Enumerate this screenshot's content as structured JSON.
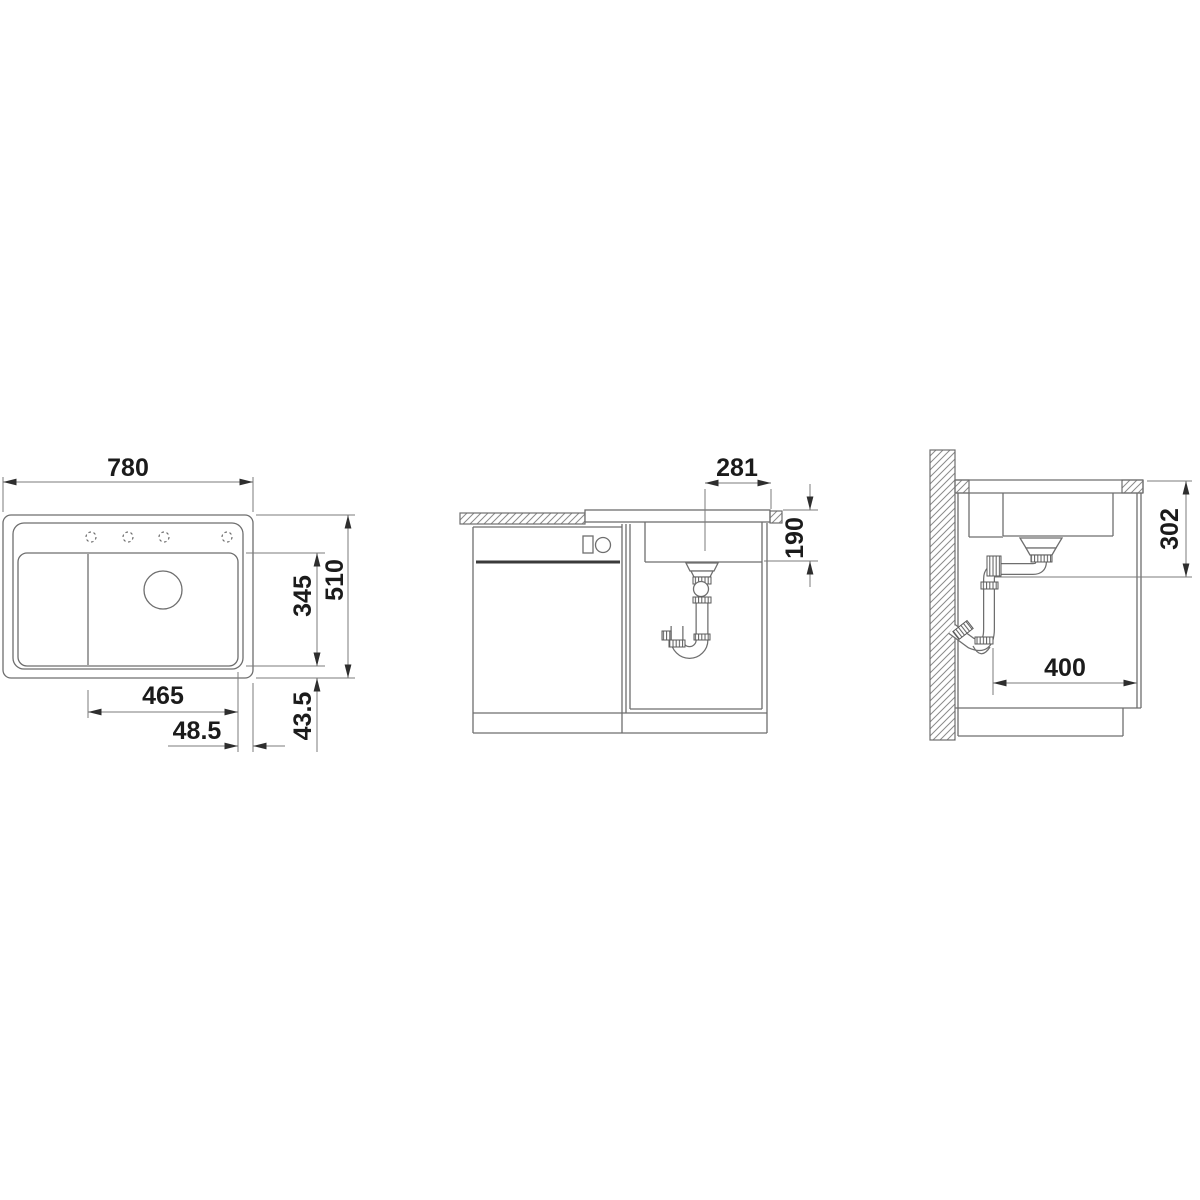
{
  "figure": {
    "type": "technical-installation-drawing",
    "views": {
      "top": {
        "dims": {
          "overall_width": "780",
          "overall_depth": "510",
          "bowl_cutout_depth": "345",
          "bowl_cutout_width": "465",
          "offset_right": "48.5",
          "offset_bottom": "43.5"
        }
      },
      "front": {
        "dims": {
          "drain_center_to_right_edge": "281",
          "bowl_depth": "190"
        }
      },
      "side": {
        "dims": {
          "drain_outlet_height": "302",
          "rear_clearance": "400"
        }
      }
    },
    "colors": {
      "outline": "#6e6e6e",
      "dimension": "#7b7b7b",
      "label": "#1b1b1b",
      "background": "#ffffff"
    }
  }
}
